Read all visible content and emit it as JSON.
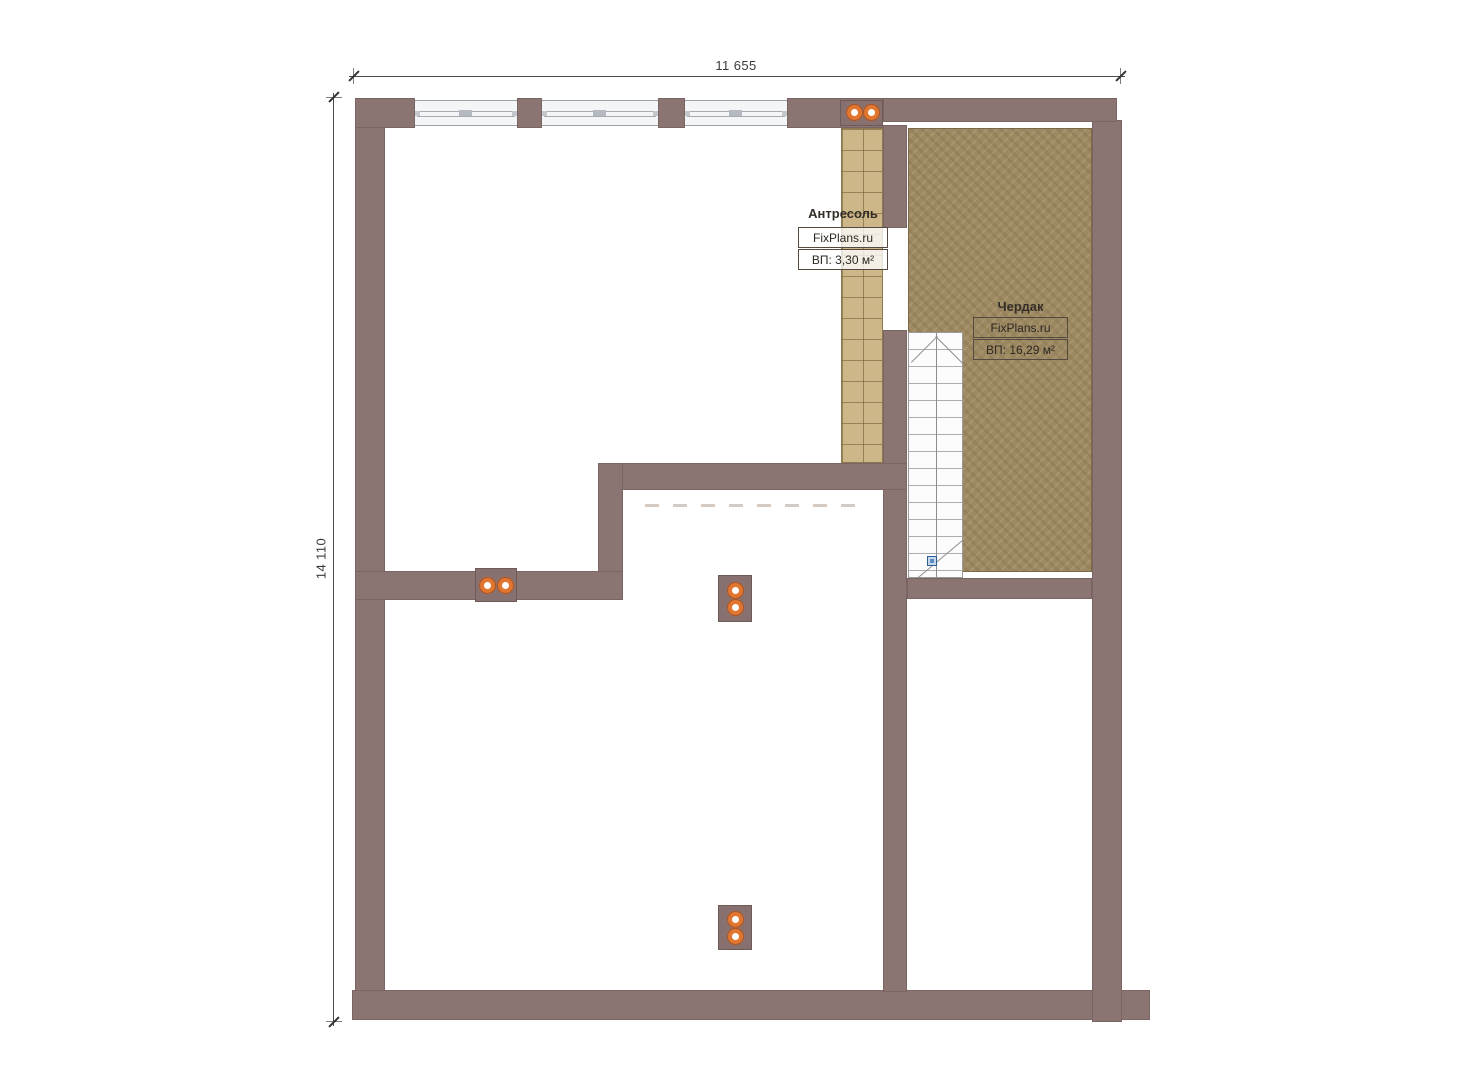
{
  "dimensions": {
    "top": "11 655",
    "left": "14 110"
  },
  "rooms": {
    "mezzanine": {
      "title": "Антресоль",
      "watermark": "FixPlans.ru",
      "area": "ВП: 3,30 м²"
    },
    "attic": {
      "title": "Чердак",
      "watermark": "FixPlans.ru",
      "area": "ВП: 16,29 м²"
    }
  },
  "icons": {
    "vent": "double-orange-vent-dots",
    "stair_marker": "blue-square-stair-direction-marker",
    "stair_arrow": "stair-run-chevron"
  },
  "colors": {
    "wall": "#8b7572",
    "mezzanine_floor": "#cdb687",
    "attic_floor": "#9d8962",
    "vent_ring": "#e0762f",
    "stair_marker": "#5b8ec4",
    "dimension_line": "#4a4a4a"
  }
}
